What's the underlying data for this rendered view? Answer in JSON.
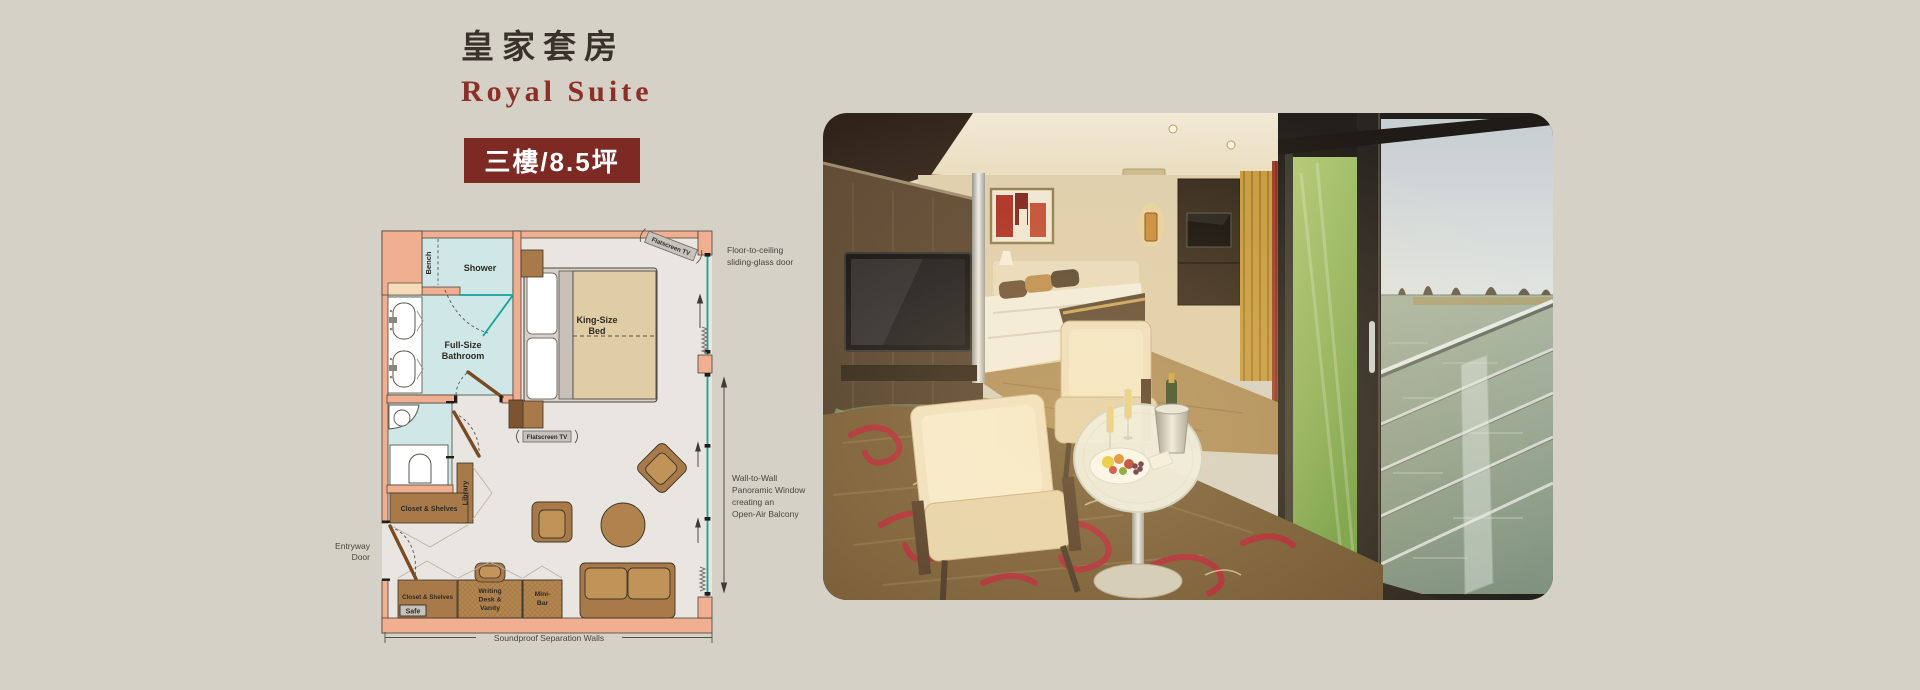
{
  "page": {
    "background": "#d5d1c7",
    "accent": "#7c2a23",
    "accent_text": "#8b2f27"
  },
  "header": {
    "title_zh": "皇家套房",
    "title_en": "Royal Suite",
    "badge": "三樓/8.5坪"
  },
  "floorplan": {
    "rooms": {
      "bench": "Bench",
      "shower": "Shower",
      "bathroom": [
        "Full-Size",
        "Bathroom"
      ],
      "bed": [
        "King-Size",
        "Bed"
      ],
      "tv_top": "Flatscreen TV",
      "tv_mid": "Flatscreen TV",
      "library": "Library",
      "closet_upper": "Closet & Shelves",
      "closet_lower": "Closet & Shelves",
      "safe": "Safe",
      "desk": [
        "Writing",
        "Desk &",
        "Vanity"
      ],
      "minibar": [
        "Mini-",
        "Bar"
      ]
    },
    "annotations": {
      "entry": [
        "Entryway",
        "Door"
      ],
      "sliding_door": [
        "Floor-to-ceiling",
        "sliding-glass door"
      ],
      "panoramic": [
        "Wall-to-Wall",
        "Panoramic Window",
        "creating an",
        "Open-Air Balcony"
      ],
      "soundproof": "Soundproof Separation Walls"
    },
    "colors": {
      "wall": "#f0af90",
      "wet_room": "#cfe8e7",
      "glass": "#12a29a",
      "furniture": "#a97a49",
      "bedding": "#e0cda6",
      "floor": "#e9e5e0"
    }
  }
}
